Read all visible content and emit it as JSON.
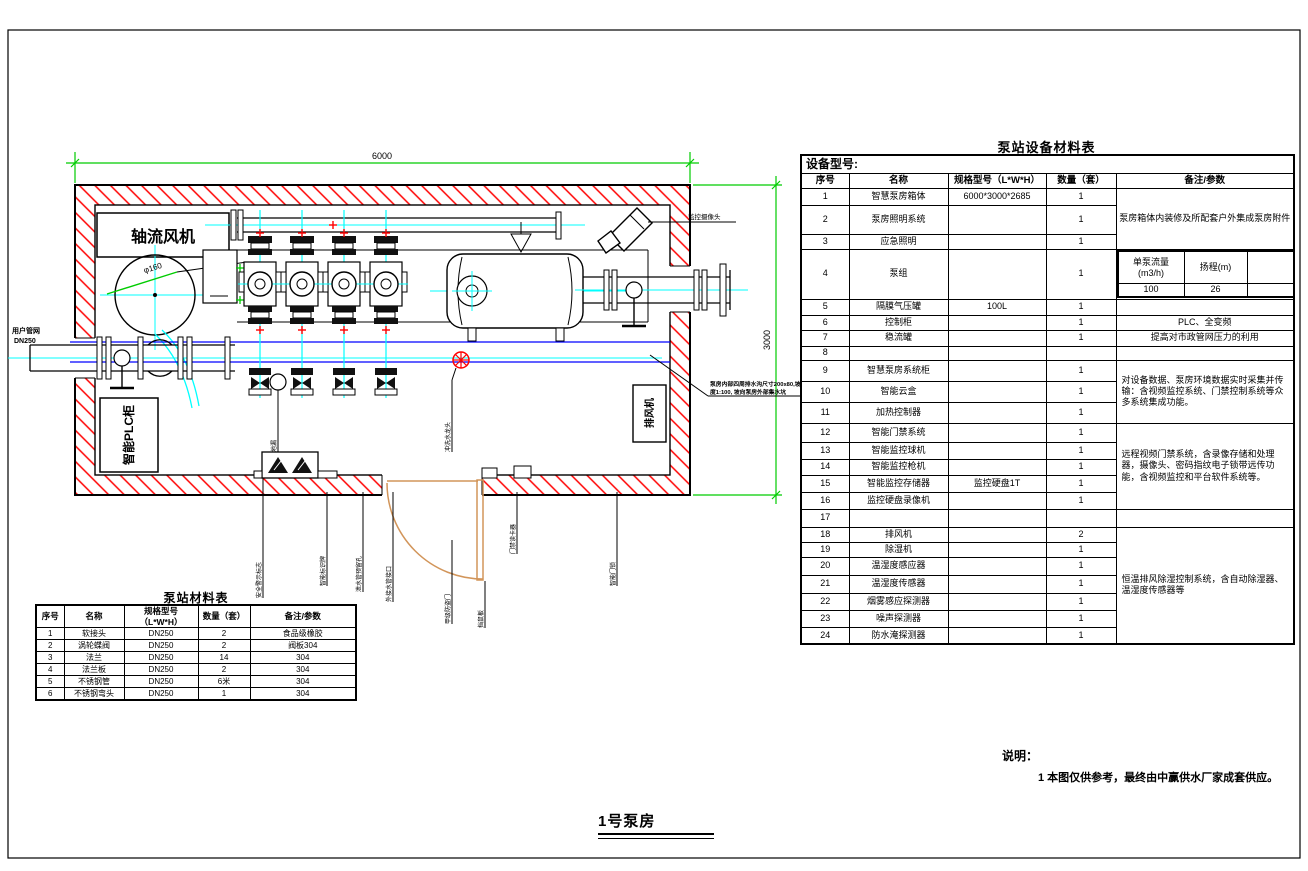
{
  "palette": {
    "wall_hatch": "#ff0000",
    "dimension_line": "#00cc00",
    "pipe_centerline": "#00ffff",
    "water_line": "#0000ff",
    "door": "#d2955a",
    "tap": "#ff0000",
    "line": "#000000"
  },
  "plan": {
    "dim_top": "6000",
    "dim_right": "3000",
    "fan_label": "轴流风机",
    "duct_dia_label": "φ160",
    "user_pipe_label": "用户管网",
    "user_pipe_dn": "DN250",
    "plc_cabinet_label": "智能PLC柜",
    "camera_label": "监控摄像头",
    "exhaust_fan_label": "排风机",
    "floor_drain_label": "地漏",
    "tap_label": "冲洗水龙头",
    "drain_note_line1": "泵房内部四周排水沟尺寸200x80,坡",
    "drain_note_line2": "度1:100, 坡向泵房外部集水坑",
    "bottom_labels": [
      "安全警示标志",
      "智能标识牌",
      "泄水管预留孔",
      "外接水管接口",
      "甲级防盗门",
      "挡鼠板",
      "门禁读卡器",
      "智能门锁"
    ]
  },
  "material_table": {
    "title": "泵站材料表",
    "headers": [
      "序号",
      "名称",
      "规格型号（L*W*H）",
      "数量（套）",
      "备注/参数"
    ],
    "rows": [
      [
        "1",
        "软接头",
        "DN250",
        "2",
        "食品级橡胶"
      ],
      [
        "2",
        "涡轮蝶阀",
        "DN250",
        "2",
        "阀板304"
      ],
      [
        "3",
        "法兰",
        "DN250",
        "14",
        "304"
      ],
      [
        "4",
        "法兰板",
        "DN250",
        "2",
        "304"
      ],
      [
        "5",
        "不锈钢管",
        "DN250",
        "6米",
        "304"
      ],
      [
        "6",
        "不锈钢弯头",
        "DN250",
        "1",
        "304"
      ]
    ]
  },
  "equipment_table": {
    "title": "泵站设备材料表",
    "model_label": "设备型号:",
    "headers": [
      "序号",
      "名称",
      "规格型号（L*W*H）",
      "数量（套）",
      "备注/参数"
    ],
    "rows": [
      {
        "no": "1",
        "name": "智慧泵房箱体",
        "spec": "6000*3000*2685",
        "qty": "1"
      },
      {
        "no": "2",
        "name": "泵房照明系统",
        "spec": "",
        "qty": "1"
      },
      {
        "no": "3",
        "name": "应急照明",
        "spec": "",
        "qty": "1"
      },
      {
        "no": "4",
        "name": "泵组",
        "spec": "",
        "qty": "1"
      },
      {
        "no": "5",
        "name": "隔膜气压罐",
        "spec": "100L",
        "qty": "1"
      },
      {
        "no": "6",
        "name": "控制柜",
        "spec": "",
        "qty": "1"
      },
      {
        "no": "7",
        "name": "稳流罐",
        "spec": "",
        "qty": "1"
      },
      {
        "no": "8",
        "name": "",
        "spec": "",
        "qty": ""
      },
      {
        "no": "9",
        "name": "智慧泵房系统柜",
        "spec": "",
        "qty": "1"
      },
      {
        "no": "10",
        "name": "智能云盒",
        "spec": "",
        "qty": "1"
      },
      {
        "no": "11",
        "name": "加热控制器",
        "spec": "",
        "qty": "1"
      },
      {
        "no": "12",
        "name": "智能门禁系统",
        "spec": "",
        "qty": "1"
      },
      {
        "no": "13",
        "name": "智能监控球机",
        "spec": "",
        "qty": "1"
      },
      {
        "no": "14",
        "name": "智能监控枪机",
        "spec": "",
        "qty": "1"
      },
      {
        "no": "15",
        "name": "智能监控存储器",
        "spec": "监控硬盘1T",
        "qty": "1"
      },
      {
        "no": "16",
        "name": "监控硬盘录像机",
        "spec": "",
        "qty": "1"
      },
      {
        "no": "17",
        "name": "",
        "spec": "",
        "qty": ""
      },
      {
        "no": "18",
        "name": "排风机",
        "spec": "",
        "qty": "2"
      },
      {
        "no": "19",
        "name": "除湿机",
        "spec": "",
        "qty": "1"
      },
      {
        "no": "20",
        "name": "温湿度感应器",
        "spec": "",
        "qty": "1"
      },
      {
        "no": "21",
        "name": "温湿度传感器",
        "spec": "",
        "qty": "1"
      },
      {
        "no": "22",
        "name": "烟雾感应探测器",
        "spec": "",
        "qty": "1"
      },
      {
        "no": "23",
        "name": "噪声探测器",
        "spec": "",
        "qty": "1"
      },
      {
        "no": "24",
        "name": "防水淹探测器",
        "spec": "",
        "qty": "1"
      }
    ],
    "remark_rows_1_3": "泵房箱体内装修及所配套户外集成泵房附件",
    "remark_row_6": "PLC、全变频",
    "remark_row_7": "提高对市政管网压力的利用",
    "remark_rows_9_11": "对设备数据、泵房环境数据实时采集并传输：含视频监控系统、门禁控制系统等众多系统集成功能。",
    "remark_rows_12_16": "远程视频门禁系统，含录像存储和处理器，摄像头、密码指纹电子锁带远传功能，含视频监控和平台软件系统等。",
    "remark_rows_18_24": "恒温排风除湿控制系统，含自动除湿器、温湿度传感器等",
    "pump_params": {
      "headers": [
        "单泵流量(m3/h)",
        "扬程(m)",
        "功率（kw）"
      ],
      "values": [
        "100",
        "26",
        "15"
      ]
    }
  },
  "notes": {
    "heading": "说明：",
    "item1": "1  本图仅供参考，最终由中赢供水厂家成套供应。"
  },
  "drawing_title": "1号泵房"
}
